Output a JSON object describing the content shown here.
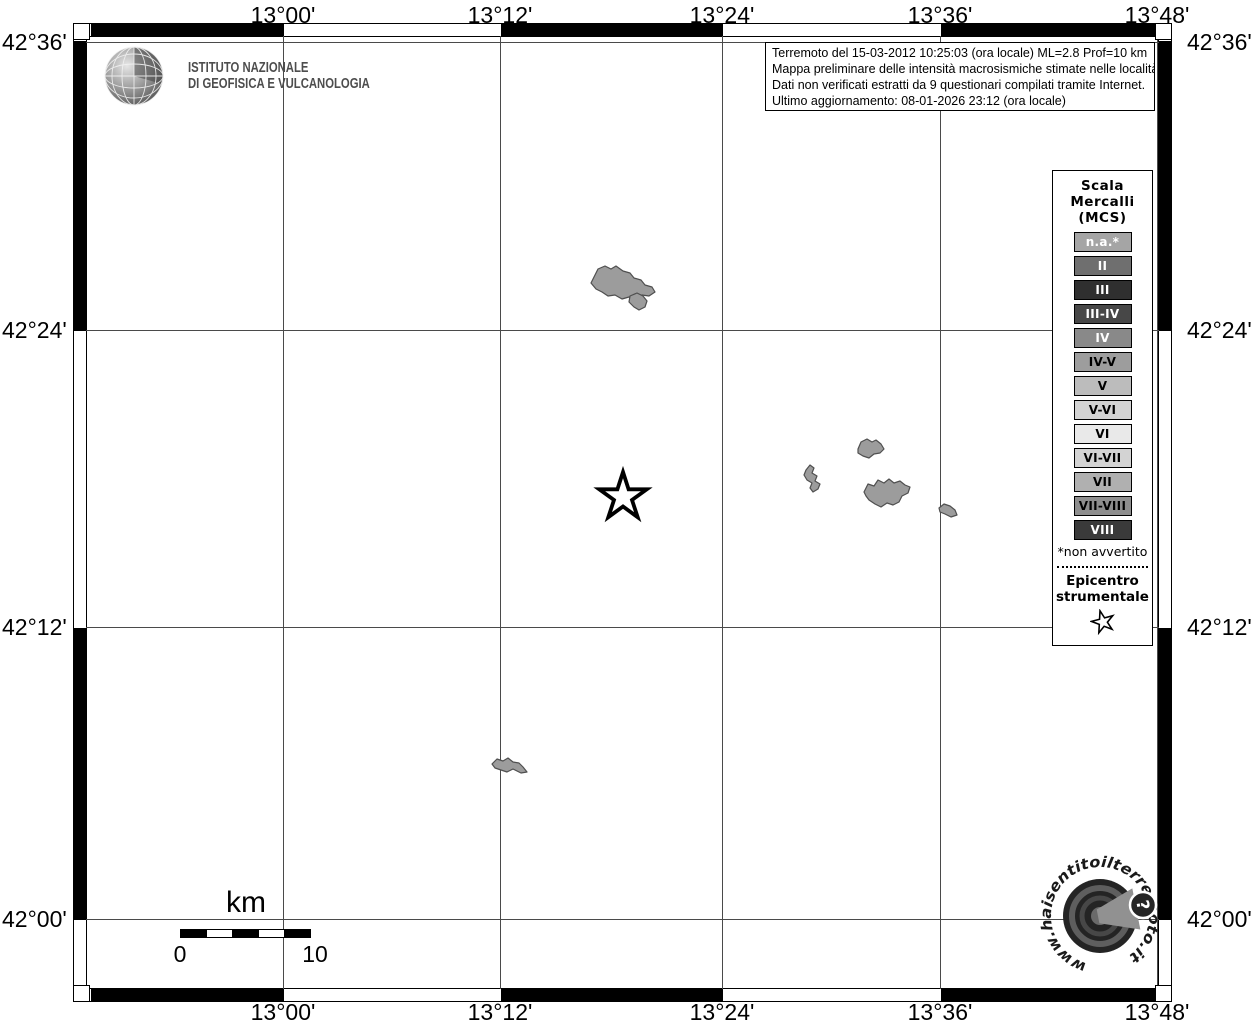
{
  "map": {
    "top_axis_labels": [
      "13°00'",
      "13°12'",
      "13°24'",
      "13°36'",
      "13°48'"
    ],
    "bottom_axis_labels": [
      "13°00'",
      "13°12'",
      "13°24'",
      "13°36'",
      "13°48'"
    ],
    "left_axis_labels": [
      "42°36'",
      "42°24'",
      "42°12'",
      "42°00'"
    ],
    "right_axis_labels": [
      "42°36'",
      "42°24'",
      "42°12'",
      "42°00'"
    ],
    "region_fill_color": "#9c9c9c",
    "epicenter_symbol": "star-outline"
  },
  "info_box": {
    "line1": "Terremoto del 15-03-2012 10:25:03 (ora locale) ML=2.8 Prof=10 km",
    "line2": "Mappa preliminare delle intensità macrosismiche stimate nelle località",
    "line3": "Dati non verificati estratti da 9 questionari compilati tramite Internet.",
    "line4": "Ultimo aggiornamento: 08-01-2026 23:12 (ora locale)"
  },
  "ingv_logo": {
    "line1": "ISTITUTO NAZIONALE",
    "line2": "DI GEOFISICA E VULCANOLOGIA"
  },
  "legend": {
    "title_lines": [
      "Scala",
      "Mercalli",
      "(MCS)"
    ],
    "items": [
      {
        "label": "n.a.*",
        "bg": "#a5a5a5",
        "fg": "#ffffff"
      },
      {
        "label": "II",
        "bg": "#6f6f6f",
        "fg": "#ffffff"
      },
      {
        "label": "III",
        "bg": "#2f2f2f",
        "fg": "#ffffff"
      },
      {
        "label": "III-IV",
        "bg": "#474747",
        "fg": "#ffffff"
      },
      {
        "label": "IV",
        "bg": "#898989",
        "fg": "#ffffff"
      },
      {
        "label": "IV-V",
        "bg": "#9d9d9d",
        "fg": "#000000"
      },
      {
        "label": "V",
        "bg": "#bcbcbc",
        "fg": "#000000"
      },
      {
        "label": "V-VI",
        "bg": "#d3d3d3",
        "fg": "#000000"
      },
      {
        "label": "VI",
        "bg": "#e9e9e9",
        "fg": "#000000"
      },
      {
        "label": "VI-VII",
        "bg": "#d3d3d3",
        "fg": "#000000"
      },
      {
        "label": "VII",
        "bg": "#b0b0b0",
        "fg": "#000000"
      },
      {
        "label": "VII-VIII",
        "bg": "#8e8e8e",
        "fg": "#000000"
      },
      {
        "label": "VIII",
        "bg": "#3a3a3a",
        "fg": "#ffffff"
      }
    ],
    "footnote": "*non avvertito",
    "epicenter_title_line1": "Epicentro",
    "epicenter_title_line2": "strumentale"
  },
  "scale_bar": {
    "unit": "km",
    "start": "0",
    "end": "10"
  },
  "watermark": {
    "text": "www.haisentitoilterremoto.it",
    "question_mark": "?"
  }
}
